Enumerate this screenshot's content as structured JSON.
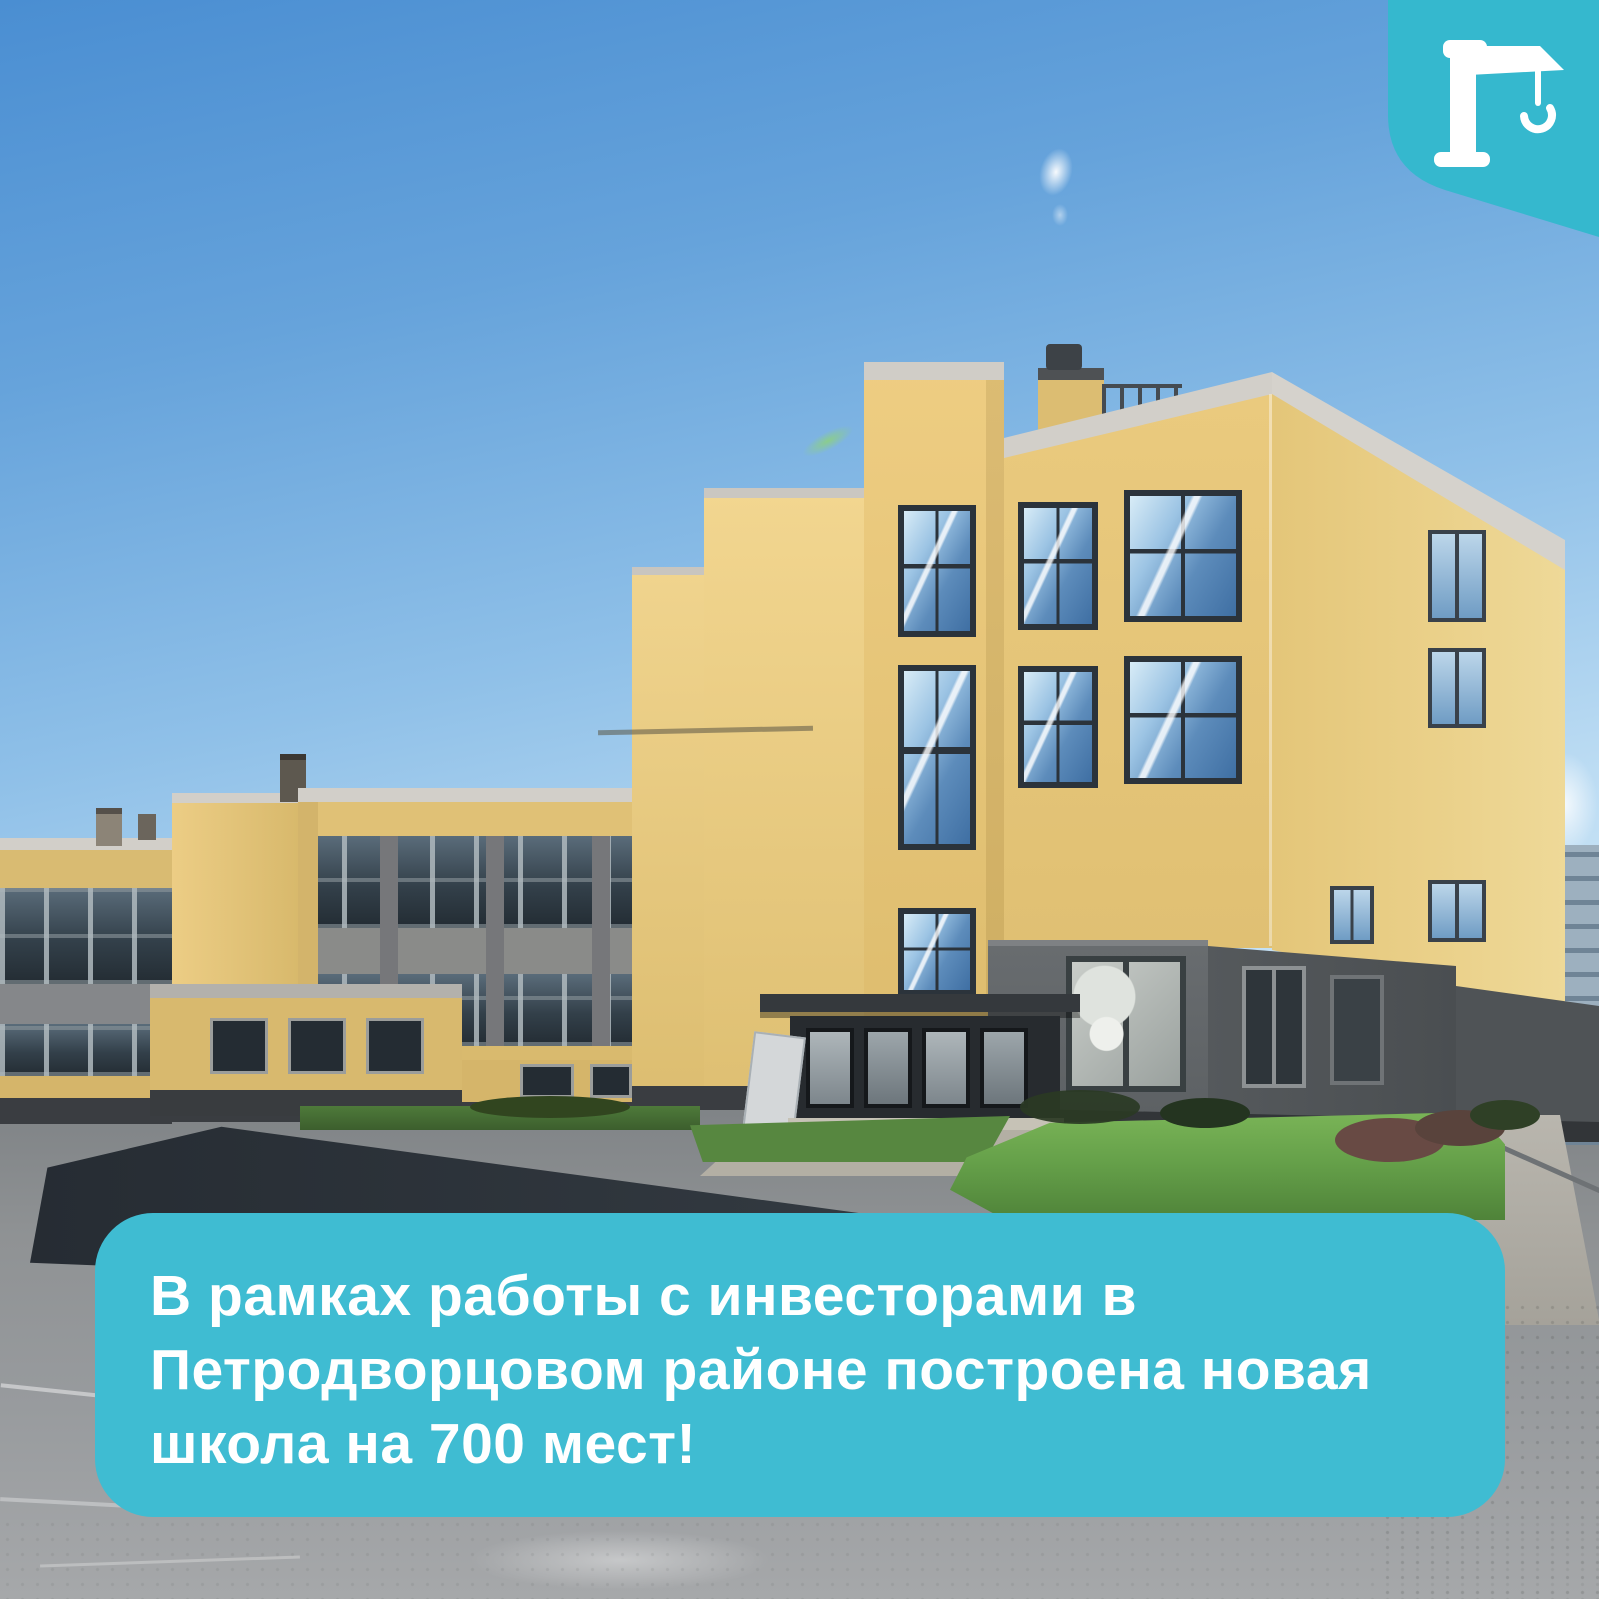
{
  "post": {
    "photo": {
      "description": "Трёхэтажное жёлто-серое здание новой школы под ясным голубым небом, газон и асфальтированная площадка"
    },
    "caption": {
      "lines": [
        "В рамках работы с инвесторами в",
        "Петродворцовом районе построена новая",
        "школа на 700 мест!"
      ],
      "full_text": "В рамках работы с инвесторами в Петродворцовом районе построена новая школа на 700 мест!"
    },
    "badge": {
      "icon": "construction-crane-icon"
    }
  },
  "theme": {
    "accent": "#3FBCD2",
    "badge_fill": "#35B8CE",
    "text_color": "#FFFFFF",
    "sky_top": "#4A8ED2",
    "sky_bottom": "#D9EDFB",
    "facade_yellow": "#EACA7E",
    "facade_shadow": "#D9B96C",
    "base_gray": "#5C6063",
    "grass_green": "#66A14A",
    "asphalt": "#989B9E"
  }
}
